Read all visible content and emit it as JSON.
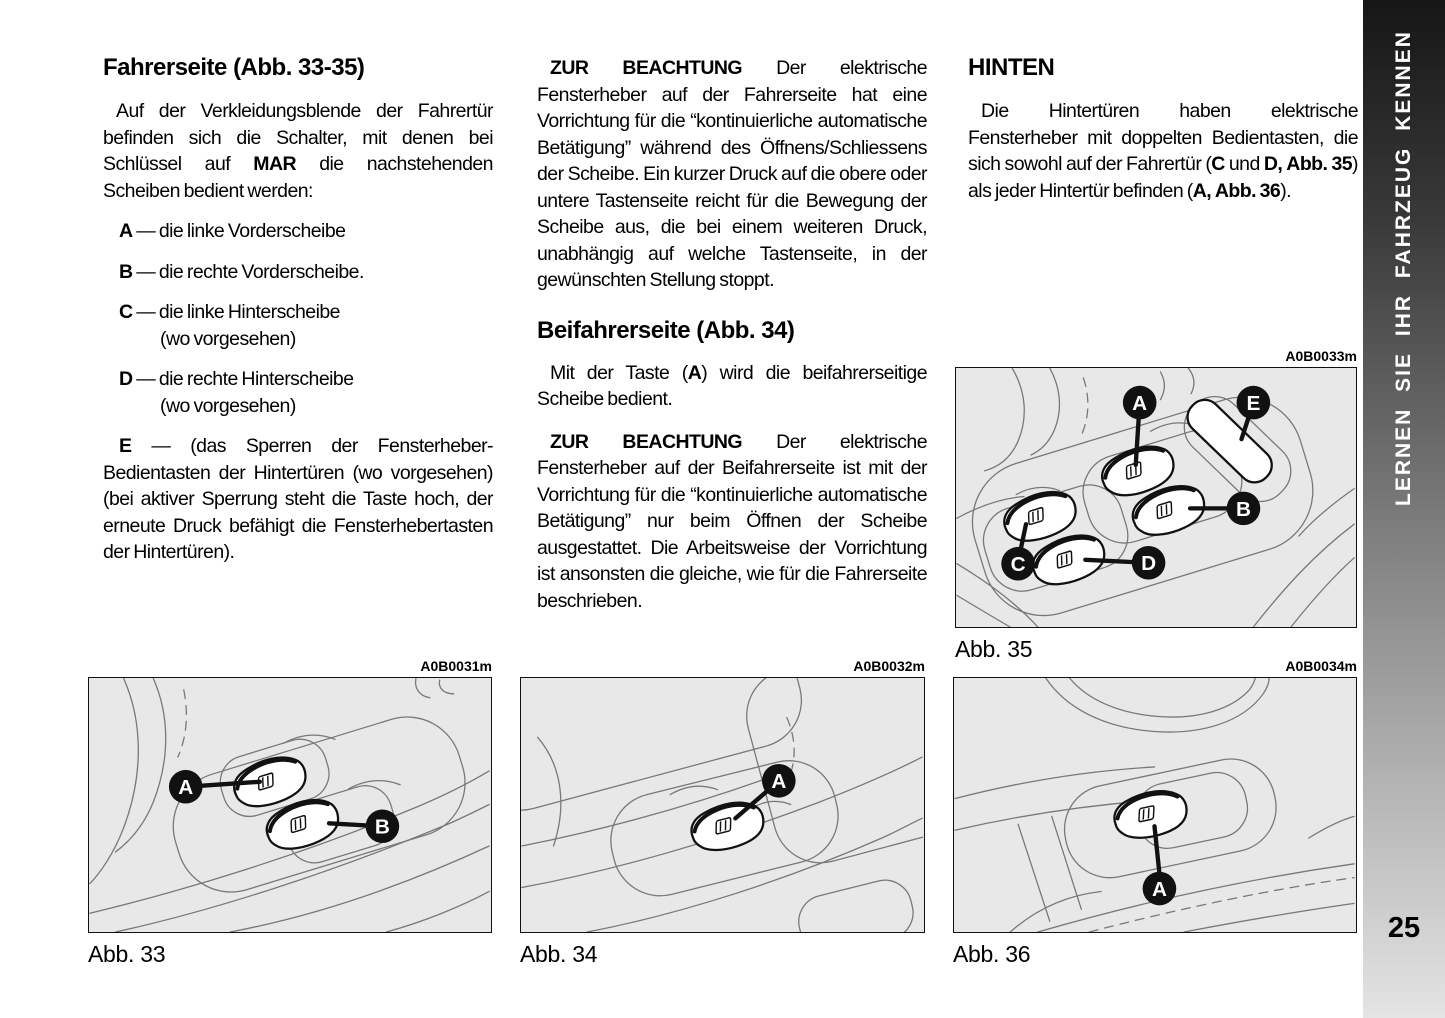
{
  "sidebar": {
    "label": "LERNEN SIE IHR FAHRZEUG KENNEN",
    "page_number": "25"
  },
  "col1": {
    "heading": "Fahrerseite (Abb. 33-35)",
    "intro": [
      {
        "t": "Auf der Verkleidungsblende der Fahrertür befinden sich die Schalter, mit denen bei Schlüssel auf "
      },
      {
        "t": "MAR",
        "b": true
      },
      {
        "t": " die nachstehenden Scheiben bedient werden:"
      }
    ],
    "items": [
      {
        "rich": [
          {
            "t": "A",
            "b": true
          },
          {
            "t": " — die linke Vorderscheibe"
          }
        ],
        "note": ""
      },
      {
        "rich": [
          {
            "t": "B",
            "b": true
          },
          {
            "t": " — die rechte Vorderscheibe."
          }
        ],
        "note": ""
      },
      {
        "rich": [
          {
            "t": "C",
            "b": true
          },
          {
            "t": " — die linke Hinterscheibe"
          }
        ],
        "note": "(wo vorgesehen)"
      },
      {
        "rich": [
          {
            "t": "D",
            "b": true
          },
          {
            "t": " — die rechte Hinterscheibe"
          }
        ],
        "note": "(wo vorgesehen)"
      },
      {
        "rich": [
          {
            "t": "E",
            "b": true
          },
          {
            "t": " — (das Sperren der Fensterheber-Bedientasten der Hintertüren (wo vorgesehen) (bei aktiver Sperrung steht die Taste hoch, der erneute Druck befähigt die Fensterhebertasten der Hintertüren)."
          }
        ],
        "note": ""
      }
    ]
  },
  "col2": {
    "p1": [
      {
        "t": "ZUR BEACHTUNG ",
        "b": true
      },
      {
        "t": "Der elektrische Fensterheber auf der Fahrerseite hat eine Vorrichtung für die “kontinuierliche automatische Betätigung” während des Öffnens/Schliessens der Scheibe. Ein kurzer Druck auf die obere oder untere Tastenseite reicht für die Bewegung der Scheibe aus, die bei einem weiteren Druck, unabhängig auf welche Tastenseite, in der gewünschten Stellung stoppt."
      }
    ],
    "heading": "Beifahrerseite (Abb. 34)",
    "p2": [
      {
        "t": "Mit der Taste ("
      },
      {
        "t": "A",
        "b": true
      },
      {
        "t": ") wird die beifahrerseitige Scheibe bedient."
      }
    ],
    "p3": [
      {
        "t": "ZUR BEACHTUNG ",
        "b": true
      },
      {
        "t": "Der elektrische Fensterheber auf der Beifahrerseite ist mit der Vorrichtung für die “kontinuierliche automatische Betätigung” nur beim Öffnen der Scheibe ausgestattet. Die Arbeitsweise der Vorrichtung ist ansonsten die gleiche, wie für die Fahrerseite beschrieben."
      }
    ]
  },
  "col3": {
    "heading": "HINTEN",
    "p": [
      {
        "t": "Die Hintertüren haben elektrische Fensterheber mit doppelten Bedientasten, die sich sowohl auf der Fahrertür ("
      },
      {
        "t": "C",
        "b": true
      },
      {
        "t": " und "
      },
      {
        "t": "D,",
        "b": true
      },
      {
        "t": " "
      },
      {
        "t": "Abb. 35",
        "b": true
      },
      {
        "t": ") als jeder Hintertür befinden ("
      },
      {
        "t": "A,",
        "b": true
      },
      {
        "t": " "
      },
      {
        "t": "Abb. 36",
        "b": true
      },
      {
        "t": ")."
      }
    ]
  },
  "figures": {
    "fig33": {
      "code": "A0B0031m",
      "caption": "Abb. 33",
      "callouts": {
        "a": "A",
        "b": "B"
      }
    },
    "fig34": {
      "code": "A0B0032m",
      "caption": "Abb. 34",
      "callouts": {
        "a": "A"
      }
    },
    "fig35": {
      "code": "A0B0033m",
      "caption": "Abb. 35",
      "callouts": {
        "a": "A",
        "b": "B",
        "c": "C",
        "d": "D",
        "e": "E"
      }
    },
    "fig36": {
      "code": "A0B0034m",
      "caption": "Abb. 36",
      "callouts": {
        "a": "A"
      }
    }
  },
  "colors": {
    "text": "#000000",
    "figure_background": "#e8e8e8",
    "callout_fill": "#111111",
    "sidebar_gradient_top": "#161616",
    "sidebar_gradient_bottom": "#e4e4e4"
  }
}
